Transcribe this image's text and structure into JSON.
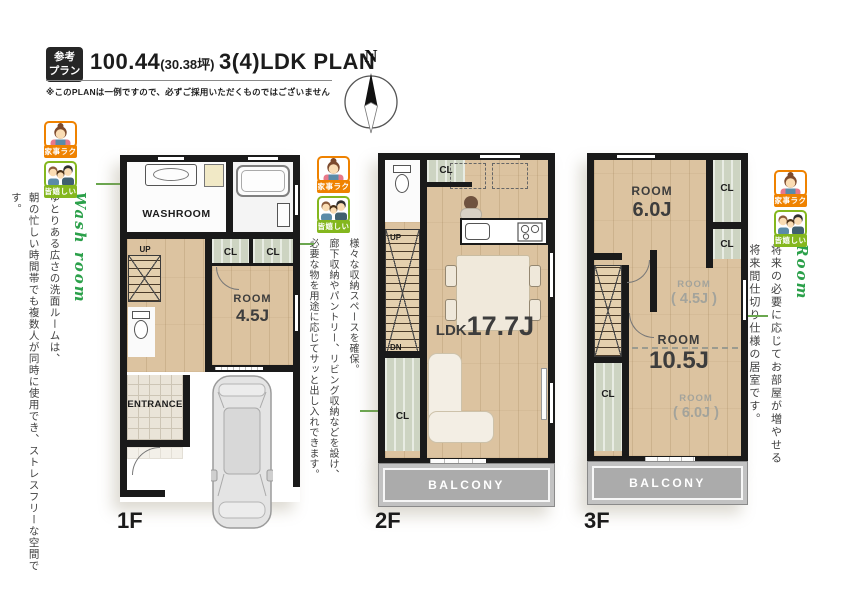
{
  "header": {
    "badge_top": "参考",
    "badge_bottom": "プラン",
    "area": "100.44",
    "tsubo": "(30.38坪)",
    "plan_type": "3(4)LDK PLAN",
    "disclaimer": "※このPLANは一例ですので、必ずご採用いただくものではございません"
  },
  "compass": {
    "north": "N"
  },
  "badges": {
    "kaji": "家事ラク",
    "ureshii": "皆嬉しい"
  },
  "annotations": {
    "wash": {
      "heading": "Wash room",
      "line1": "ゆとりある広さの洗面ルームは、",
      "line2": "朝の忙しい時間帯でも複数人が同時に使用でき、ストレスフリーな空間です。"
    },
    "storage": {
      "line1": "様々な収納スペースを確保。",
      "line2": "廊下収納やパントリー、リビング収納などを設け、",
      "line3": "必要な物を用途に応じてサッと出し入れできます。"
    },
    "future_room": {
      "heading": "Room",
      "line1": "将来の必要に応じてお部屋が増やせる",
      "line2": "将来間仕切り仕様の居室です。"
    }
  },
  "floor1": {
    "label": "1F",
    "washroom": "WASHROOM",
    "up": "UP",
    "cl1": "CL",
    "cl2": "CL",
    "room_name": "ROOM",
    "room_size": "4.5J",
    "entrance": "ENTRANCE"
  },
  "floor2": {
    "label": "2F",
    "cl_top": "CL",
    "up": "UP",
    "dn": "DN",
    "ldk_name": "LDK",
    "ldk_size": "17.7J",
    "cl_side": "CL",
    "balcony": "BALCONY"
  },
  "floor3": {
    "label": "3F",
    "room1_name": "ROOM",
    "room1_size": "6.0J",
    "cl1": "CL",
    "cl2": "CL",
    "room2_name": "ROOM",
    "room2_size": "( 4.5J )",
    "room3_name": "ROOM",
    "room3_size": "10.5J",
    "room4_name": "ROOM",
    "room4_size": "( 6.0J )",
    "cl3": "CL",
    "balcony": "BALCONY"
  },
  "colors": {
    "accent_green": "#2ba04a",
    "pointer_green": "#6aa74e",
    "badge_orange": "#ef8200",
    "badge_green": "#84b71e"
  }
}
